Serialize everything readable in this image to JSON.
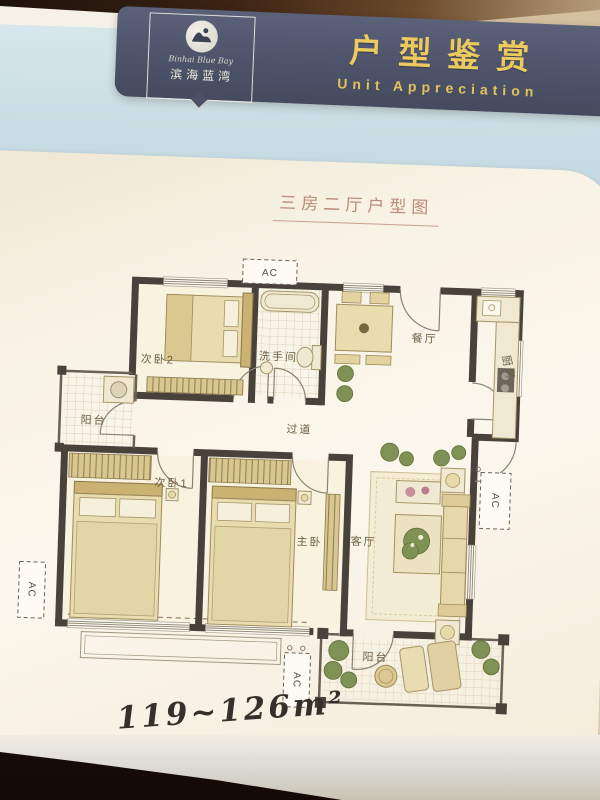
{
  "header": {
    "badge": {
      "name_script": "Binhai Blue Bay",
      "name_cn": "滨海蓝湾"
    },
    "title_cn": "户型鉴赏",
    "title_en": "Unit Appreciation"
  },
  "page": {
    "plan_title": "三房二厅户型图",
    "area_text": "119~126m²"
  },
  "plan": {
    "rooms": [
      {
        "id": "bed2",
        "label": "次卧2"
      },
      {
        "id": "bathroom",
        "label": "洗手间"
      },
      {
        "id": "dining",
        "label": "餐厅"
      },
      {
        "id": "kitchen",
        "label": "厨房"
      },
      {
        "id": "balcony-left",
        "label": "阳台"
      },
      {
        "id": "corridor",
        "label": "过道"
      },
      {
        "id": "bed1",
        "label": "次卧1"
      },
      {
        "id": "master",
        "label": "主卧"
      },
      {
        "id": "living",
        "label": "客厅"
      },
      {
        "id": "balcony-bottom",
        "label": "阳台"
      }
    ],
    "ac_labels": [
      "AC",
      "AC",
      "AC",
      "AC"
    ]
  },
  "colors": {
    "band": "#4c5268",
    "gold": "#ecca5e",
    "blue_card": "#cfe2e9",
    "page": "#f9f4e7",
    "wall": "#49423a",
    "plan_title": "#bd8b7b",
    "ink": "#35302a"
  }
}
